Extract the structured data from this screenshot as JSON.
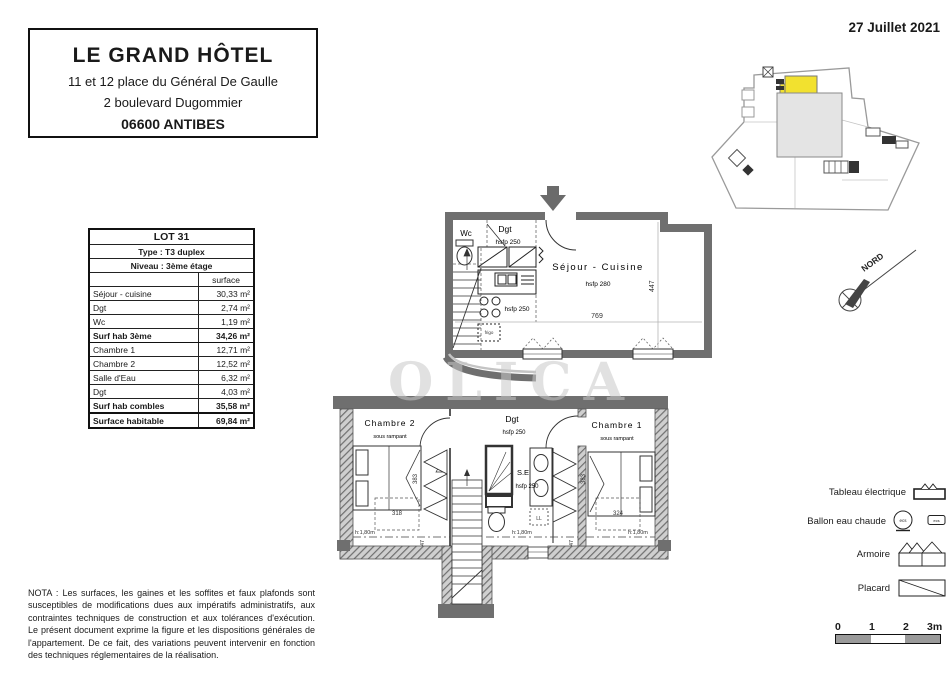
{
  "header": {
    "date": "27 Juillet 2021"
  },
  "title_block": {
    "name": "LE GRAND HÔTEL",
    "address_line1": "11 et 12 place du Général De Gaulle",
    "address_line2": "2 boulevard Dugommier",
    "city": "06600 ANTIBES"
  },
  "lot_table": {
    "lot": "LOT 31",
    "type": "Type : T3 duplex",
    "level": "Niveau : 3ème étage",
    "surface_header": "surface",
    "rows": [
      {
        "label": "Séjour - cuisine",
        "value": "30,33 m²"
      },
      {
        "label": "Dgt",
        "value": "2,74 m²"
      },
      {
        "label": "Wc",
        "value": "1,19 m²"
      },
      {
        "label": "Surf hab 3ème",
        "value": "34,26 m²"
      },
      {
        "label": "Chambre 1",
        "value": "12,71 m²"
      },
      {
        "label": "Chambre 2",
        "value": "12,52 m²"
      },
      {
        "label": "Salle d'Eau",
        "value": "6,32 m²"
      },
      {
        "label": "Dgt",
        "value": "4,03 m²"
      },
      {
        "label": "Surf hab combles",
        "value": "35,58 m²"
      },
      {
        "label": "Surface habitable",
        "value": "69,84 m²"
      }
    ]
  },
  "watermark": "OLICA",
  "upper_plan": {
    "wc": "Wc",
    "dgt": "Dgt",
    "hsfp250": "hsfp 250",
    "frigo": "frigo",
    "room": "Séjour - Cuisine",
    "hsfp280": "hsfp 280",
    "dim_height": "447",
    "dim_width": "769"
  },
  "lower_plan": {
    "chambre2": "Chambre 2",
    "chambre1": "Chambre 1",
    "sous_rampant": "sous rampant",
    "dgt": "Dgt",
    "hsfp250": "hsfp 250",
    "se": "S.E",
    "ll": "LL",
    "dim_383": "383",
    "dim_318": "318",
    "dim_324": "324",
    "dim_47": "47",
    "h180": "h:1,80m"
  },
  "compass": {
    "label": "NORD"
  },
  "legend": {
    "items": [
      {
        "label": "Tableau électrique"
      },
      {
        "label": "Ballon eau chaude"
      },
      {
        "label": "Armoire"
      },
      {
        "label": "Placard"
      }
    ],
    "ecs": "ecs"
  },
  "scale_bar": {
    "ticks": [
      "0",
      "1",
      "2",
      "3m"
    ]
  },
  "nota": {
    "text": "NOTA : Les surfaces, les gaines et les soffites et faux plafonds sont susceptibles de modifications dues aux impératifs administratifs, aux contraintes techniques de construction et aux tolérances d'exécution. Le présent document exprime la figure et les dispositions générales de l'appartement. De ce fait, des variations peuvent intervenir en fonction des techniques réglementaires de la réalisation."
  }
}
